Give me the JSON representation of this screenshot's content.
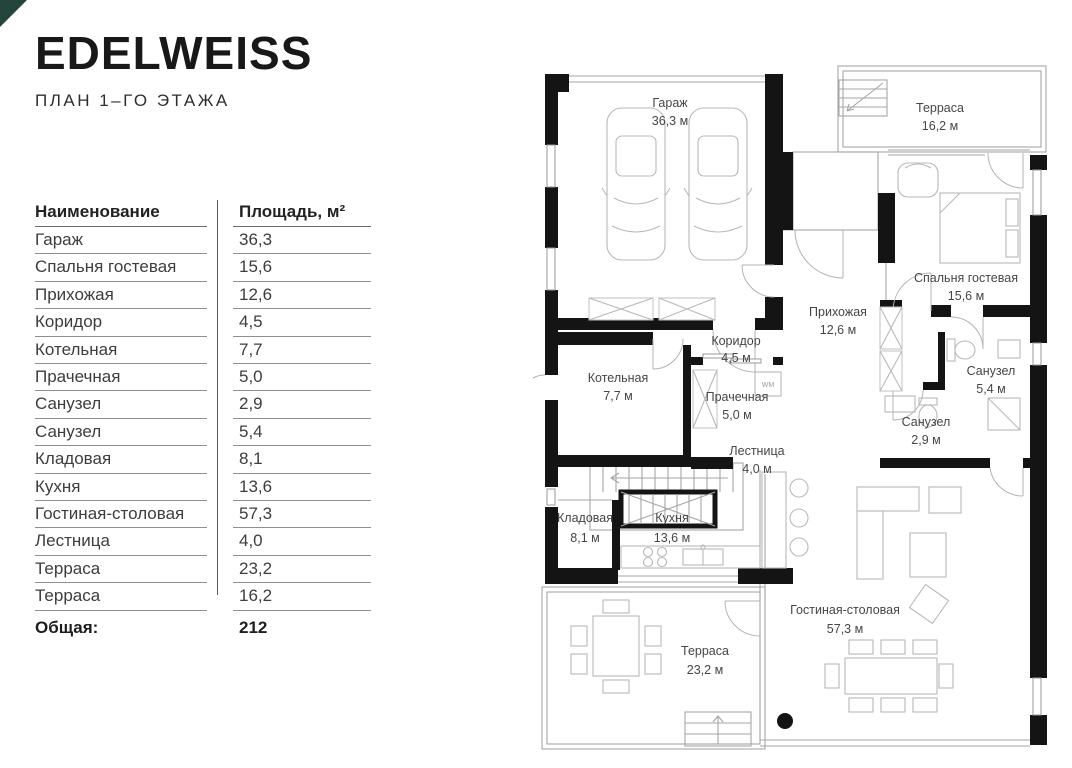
{
  "header": {
    "logo": "EDELWEISS",
    "subtitle": "ПЛАН 1–ГО ЭТАЖА"
  },
  "table": {
    "col_name": "Наименование",
    "col_area": "Площадь, м²",
    "rows": [
      {
        "name": "Гараж",
        "area": "36,3"
      },
      {
        "name": "Спальня гостевая",
        "area": "15,6"
      },
      {
        "name": "Прихожая",
        "area": "12,6"
      },
      {
        "name": "Коридор",
        "area": "4,5"
      },
      {
        "name": "Котельная",
        "area": "7,7"
      },
      {
        "name": "Прачечная",
        "area": "5,0"
      },
      {
        "name": "Санузел",
        "area": "2,9"
      },
      {
        "name": "Санузел",
        "area": "5,4"
      },
      {
        "name": "Кладовая",
        "area": "8,1"
      },
      {
        "name": "Кухня",
        "area": "13,6"
      },
      {
        "name": "Гостиная-столовая",
        "area": "57,3"
      },
      {
        "name": "Лестница",
        "area": "4,0"
      },
      {
        "name": "Терраса",
        "area": "23,2"
      },
      {
        "name": "Терраса",
        "area": "16,2"
      }
    ],
    "total_label": "Общая:",
    "total_value": "212"
  },
  "plan": {
    "rooms": [
      {
        "name": "Гараж",
        "area": "36,3 м"
      },
      {
        "name": "Терраса",
        "area": "16,2 м"
      },
      {
        "name": "Спальня гостевая",
        "area": "15,6 м"
      },
      {
        "name": "Прихожая",
        "area": "12,6 м"
      },
      {
        "name": "Коридор",
        "area": "4,5 м"
      },
      {
        "name": "Котельная",
        "area": "7,7 м"
      },
      {
        "name": "Прачечная",
        "area": "5,0 м"
      },
      {
        "name": "Санузел",
        "area": "5,4 м"
      },
      {
        "name": "Санузел",
        "area": "2,9 м"
      },
      {
        "name": "Лестница",
        "area": "4,0 м"
      },
      {
        "name": "Кладовая",
        "area": "8,1 м"
      },
      {
        "name": "Кухня",
        "area": "13,6 м"
      },
      {
        "name": "Гостиная-столовая",
        "area": "57,3 м"
      },
      {
        "name": "Терраса",
        "area": "23,2 м"
      }
    ],
    "wm_label": "WM"
  },
  "colors": {
    "accent": "#23453b",
    "wall": "#141414",
    "thin_line": "#a6a6a6",
    "text": "#3d3d3d"
  }
}
